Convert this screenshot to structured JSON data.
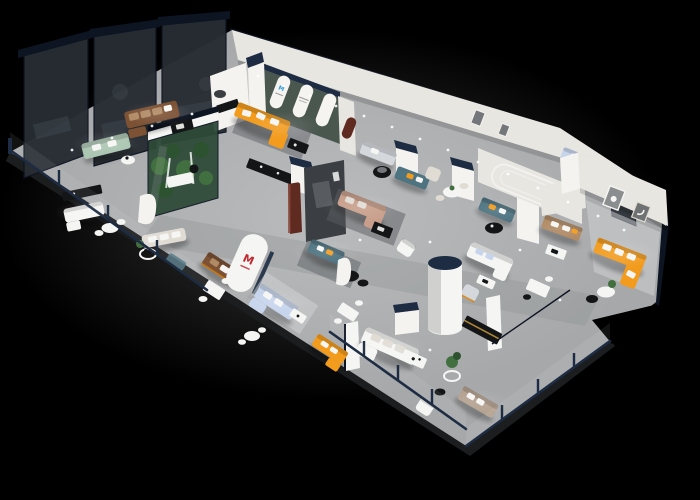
{
  "scene": {
    "description": "isometric 3d render of a furniture showroom floor plan on black background",
    "background": "#000000",
    "palette": {
      "bg": "#000000",
      "floor": "#a6a8aa",
      "floor-hi": "#c7c9cb",
      "aisle": "#8f9193",
      "rug": "#d3d4d6",
      "rug-dark": "#595c5f",
      "slab": "#1b1d1f",
      "wall": "#e8e6e1",
      "wall-hi": "#f4f3ef",
      "wall-sh": "#c9c7c2",
      "navy": "#1d2c42",
      "navy-dk": "#0d1422",
      "glassw": "#272d33",
      "glass-int": "#4a535b",
      "arch-wall": "#4a574f",
      "arch-panel": "#f5f4f0",
      "logo-blue": "#2f9cd8",
      "logo-red": "#c2272e",
      "orange": "#f29b1d",
      "orange-dk": "#cf7c0e",
      "brown": "#7c5134",
      "tan": "#b08a64",
      "taupe": "#b4a190",
      "sage": "#abc5b1",
      "blue-pale": "#c6d4ec",
      "silver": "#d4d8dd",
      "blush": "#c89e8a",
      "teal": "#4e7381",
      "char": "#3b3e42",
      "char-hi": "#585c61",
      "blackf": "#141517",
      "white": "#f5f5f3",
      "cream": "#e0dcd4",
      "plant": "#416f3f",
      "plant-dk": "#2c5230",
      "maroon": "#5f2a20",
      "gold": "#c79a3d",
      "dim": "#73767a"
    },
    "logos": {
      "arch_badge": "M",
      "brand_mark": "M"
    },
    "areas": [
      {
        "name": "tinted-glass-offices",
        "position": "back-left",
        "features": "3 dark glass panels, dim interiors"
      },
      {
        "name": "lounge-displays-left",
        "position": "left",
        "features": "sage sofa, brown sectional, black coffee table"
      },
      {
        "name": "indoor-garden-case",
        "position": "center-left",
        "features": "glass terrarium with plants"
      },
      {
        "name": "arched-gallery-lounge",
        "position": "back-center",
        "features": "green wall, 3 white arches, blue logo, orange L-sofa"
      },
      {
        "name": "central-sofa-displays",
        "position": "center",
        "features": "blush sectional, teal sofas, charcoal media wall, maroon panel"
      },
      {
        "name": "front-glass-gallery",
        "position": "front-left",
        "features": "white sectional, cream sofa, leather sofa, brand logo wall, dining sets"
      },
      {
        "name": "molding-arc-wall-zone",
        "position": "center-right",
        "features": "arc moldings, teal loveseat, white sectional, tan sofa"
      },
      {
        "name": "cylinder-rotunda",
        "position": "right-center",
        "features": "white cylinder with navy top, black gold-trim cabinet"
      },
      {
        "name": "orange-lounge-suite",
        "position": "far-right",
        "features": "orange L-sofa, wall frames, round table"
      },
      {
        "name": "front-sofa-gallery",
        "position": "bottom",
        "features": "orange chaise sofa, white sectional, taupe sofa, plant tables"
      }
    ],
    "furniture": [
      {
        "item": "sage-sofa",
        "color_key": "sage"
      },
      {
        "item": "brown-sectional",
        "color_key": "brown"
      },
      {
        "item": "orange-l-sofa-arch-room",
        "color_key": "orange"
      },
      {
        "item": "orange-l-sofa-right-room",
        "color_key": "orange"
      },
      {
        "item": "orange-chaise-sofa-front",
        "color_key": "orange"
      },
      {
        "item": "blush-sectional",
        "color_key": "blush"
      },
      {
        "item": "teal-sofa-back",
        "color_key": "teal"
      },
      {
        "item": "teal-sofa-center",
        "color_key": "teal"
      },
      {
        "item": "teal-loveseat-arcwall",
        "color_key": "teal"
      },
      {
        "item": "powder-blue-sectional",
        "color_key": "blue-pale"
      },
      {
        "item": "pale-blue-sofa-back",
        "color_key": "blue-pale"
      },
      {
        "item": "silver-sofa",
        "color_key": "silver"
      },
      {
        "item": "leather-sofa",
        "color_key": "brown"
      },
      {
        "item": "cream-sofa",
        "color_key": "cream"
      },
      {
        "item": "white-sectional-front",
        "color_key": "white"
      },
      {
        "item": "white-sectional-right",
        "color_key": "white"
      },
      {
        "item": "tan-sofa",
        "color_key": "tan"
      },
      {
        "item": "taupe-sofa",
        "color_key": "taupe"
      },
      {
        "item": "white-armchairs",
        "color_key": "white"
      },
      {
        "item": "black-round-coffee-tables",
        "color_key": "blackf"
      },
      {
        "item": "black-media-cabinets",
        "color_key": "blackf"
      },
      {
        "item": "gold-trim-display-cabinet",
        "color_key": "gold"
      },
      {
        "item": "white-dining-sets",
        "color_key": "white"
      },
      {
        "item": "cylinder-column",
        "color_key": "white"
      },
      {
        "item": "glass-facade-rails",
        "color_key": "navy"
      },
      {
        "item": "potted-plants",
        "color_key": "plant"
      }
    ],
    "counts": {
      "tinted_glass_panels": 3,
      "arched_niches": 3,
      "navy_column_caps": 6
    }
  }
}
